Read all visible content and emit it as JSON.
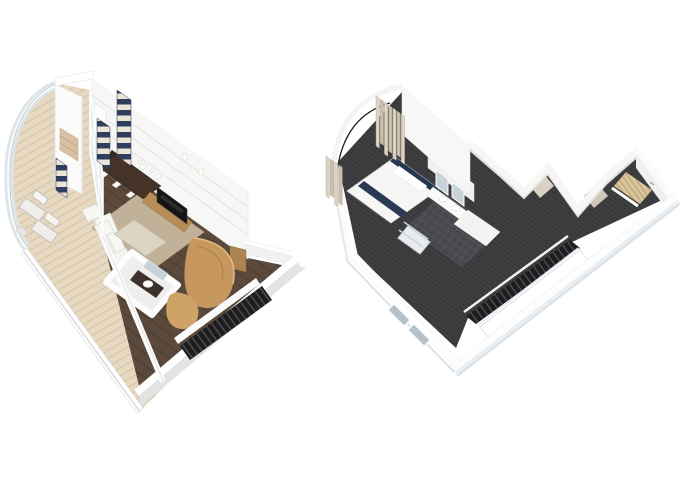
{
  "scene": {
    "background": "#ffffff",
    "description": "pair of isometric 3D floor-plan renderings of a two-level loft suite"
  },
  "colors": {
    "deck_wood": "#e6d8c1",
    "deck_plank_line": "#d5c3a6",
    "interior_wood_floor": "#5b4a3b",
    "area_rug": "#c2b199",
    "wall_white": "#f7f7f6",
    "wall_face_shadow": "#e2e3e4",
    "railing_glass": "#dde5e9",
    "window_glass": "#b6c1c8",
    "facade_glass": "#e8eef1",
    "navy_stripe": "#2e3e5c",
    "cream_stripe": "#eae5d6",
    "furniture_wood": "#b78c55",
    "closet_wood": "#c6985f",
    "closet_wood_light": "#cfa268",
    "table_dark": "#453327",
    "tv_black": "#141414",
    "carpet_charcoal": "#3a3a3c",
    "bath_tile": "#47484d",
    "stair_black": "#1d1d1f",
    "step_wood": "#d9c49c",
    "mirror_glass": "#c7d3d9",
    "beige_curtain": "#dcd3c3",
    "beige_curtain_dark": "#c8bfae",
    "headboard_navy": "#263650",
    "bed_white": "#f6f6f4",
    "outer_wall_face": "#e9eef2",
    "sofa_white": "#f6f6f3",
    "ottoman_beige": "#ddd5c4",
    "counter_dark": "#3c322b",
    "door_wood": "#ad8555"
  },
  "plans": [
    {
      "id": "lower-level",
      "position": "left",
      "rooms": [
        "balcony-deck",
        "dining-area",
        "living-area",
        "powder-room",
        "entry-hall",
        "staircase"
      ],
      "furniture_counts": {
        "loungers": 2,
        "dining_chairs": 6,
        "striped_curtains": 3,
        "armchairs": 2,
        "sofas": 1,
        "tv": 1
      }
    },
    {
      "id": "upper-level",
      "position": "right",
      "rooms": [
        "master-bedroom",
        "bathroom",
        "wardrobe-hallway",
        "staircase",
        "void-over-living-room"
      ],
      "furniture_counts": {
        "beds": 1,
        "pillows": 2,
        "mirrors": 2,
        "sinks": 2,
        "curtain_panels": 11,
        "wall_windows": 2
      }
    }
  ]
}
